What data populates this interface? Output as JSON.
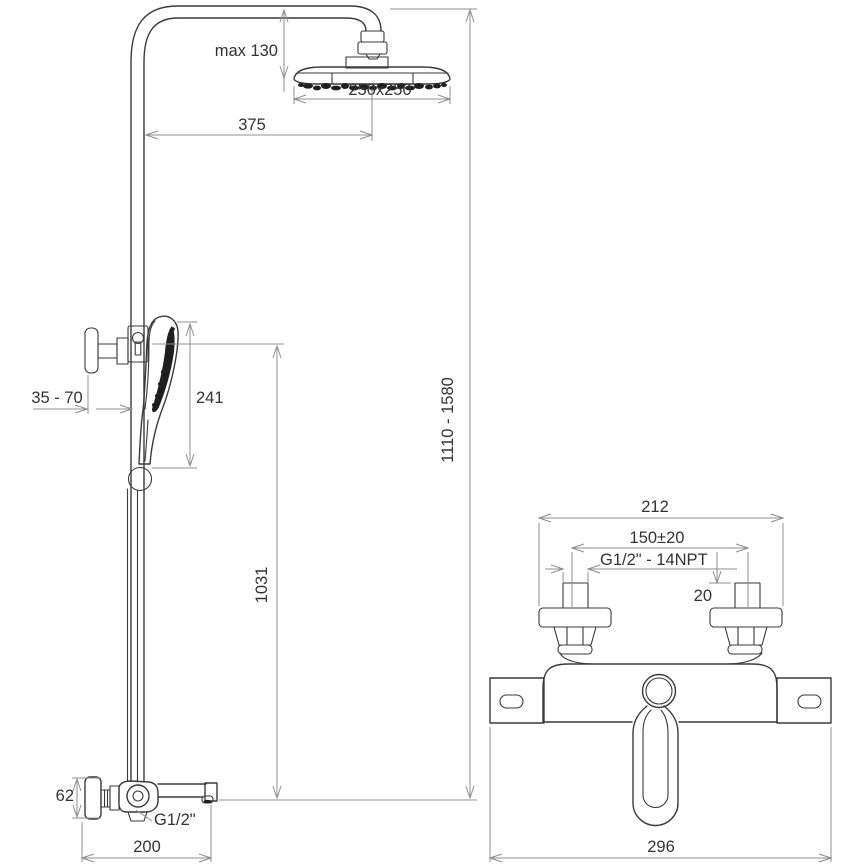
{
  "figures": {
    "shower_column": {
      "title": "shower column side view",
      "dims": {
        "head_offset_max": "max 130",
        "head_size": "250x250",
        "arm_reach": "375",
        "bracket_offset": "35 - 70",
        "hand_shower_length": "241",
        "riser_height_range": "1110 - 1580",
        "riser_lower_height": "1031",
        "spout_body_height": "62",
        "spout_thread": "G1/2\"",
        "spout_reach": "200"
      }
    },
    "mixer_front": {
      "title": "wall mixer front view",
      "dims": {
        "flange_span": "212",
        "inlet_spacing": "150±20",
        "inlet_thread": "G1/2\" - 14NPT",
        "inlet_protrusion": "20",
        "overall_width": "296"
      }
    }
  },
  "colors": {
    "line": "#3a3a3a",
    "dimension": "#8f8f8f",
    "label": "#333333",
    "background": "#ffffff"
  }
}
